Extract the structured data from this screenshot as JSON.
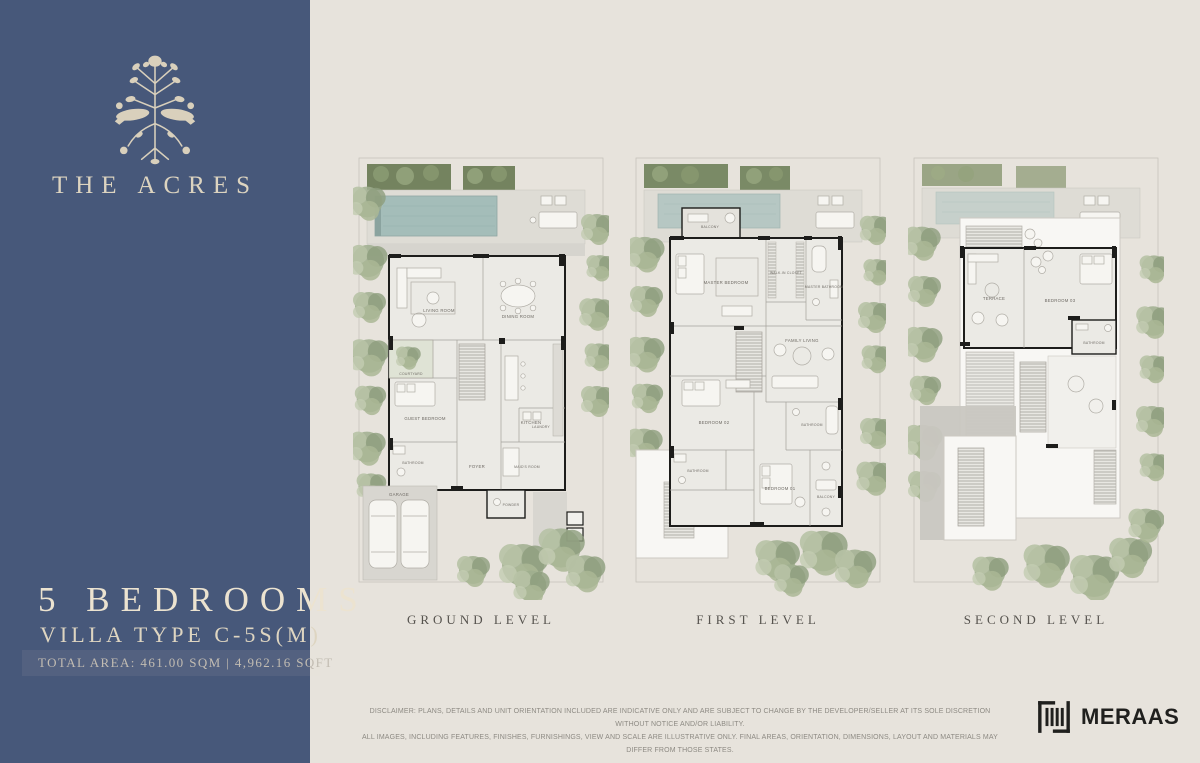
{
  "sidebar": {
    "brand_name": "THE ACRES",
    "headline": "5 BEDROOMS",
    "subheadline": "VILLA TYPE C-5S(M)",
    "total_area": "TOTAL AREA: 461.00 SQM | 4,962.16 SQFT"
  },
  "plans": [
    {
      "label": "GROUND LEVEL",
      "rooms": {
        "living_room": "LIVING ROOM",
        "dining_room": "DINING ROOM",
        "kitchen": "KITCHEN",
        "courtyard": "COURTYARD",
        "guest_bedroom": "GUEST BEDROOM",
        "bathroom": "BATHROOM",
        "foyer": "FOYER",
        "maids_room": "MAID'S ROOM",
        "laundry": "LAUNDRY",
        "powder": "POWDER",
        "garage": "GARAGE"
      }
    },
    {
      "label": "FIRST LEVEL",
      "rooms": {
        "balcony_top": "BALCONY",
        "master_bedroom": "MASTER BEDROOM",
        "walk_in_closet": "WALK-IN CLOSET",
        "master_bathroom": "MASTER BATHROOM",
        "family_living": "FAMILY LIVING",
        "bedroom_02": "BEDROOM 02",
        "bathroom_left": "BATHROOM",
        "bathroom_right": "BATHROOM",
        "bedroom_01": "BEDROOM 01",
        "balcony_bottom": "BALCONY"
      }
    },
    {
      "label": "SECOND LEVEL",
      "rooms": {
        "terrace": "TERRACE",
        "bedroom_03": "BEDROOM 03",
        "bathroom": "BATHROOM"
      }
    }
  ],
  "footer": {
    "disclaimer_line1": "DISCLAIMER: PLANS, DETAILS AND UNIT ORIENTATION INCLUDED ARE INDICATIVE ONLY AND ARE SUBJECT TO CHANGE BY THE DEVELOPER/SELLER AT ITS SOLE DISCRETION WITHOUT NOTICE AND/OR LIABILITY.",
    "disclaimer_line2": "ALL IMAGES, INCLUDING FEATURES, FINISHES, FURNISHINGS, VIEW AND SCALE ARE ILLUSTRATIVE ONLY. FINAL AREAS, ORIENTATION, DIMENSIONS, LAYOUT AND MATERIALS MAY DIFFER FROM THOSE STATES.",
    "developer_logo_text": "MERAAS"
  },
  "colors": {
    "sidebar_blue": "#47587a",
    "background": "#e7e3dc",
    "pool_teal": "#a4bdb9",
    "vegetation_green": "#9fae8e",
    "cream_text": "#ddd4c0",
    "wall_black": "#1d1d1b"
  },
  "icons": {
    "emblem": "botanical-emblem-icon",
    "developer": "meraas-bars-icon"
  }
}
